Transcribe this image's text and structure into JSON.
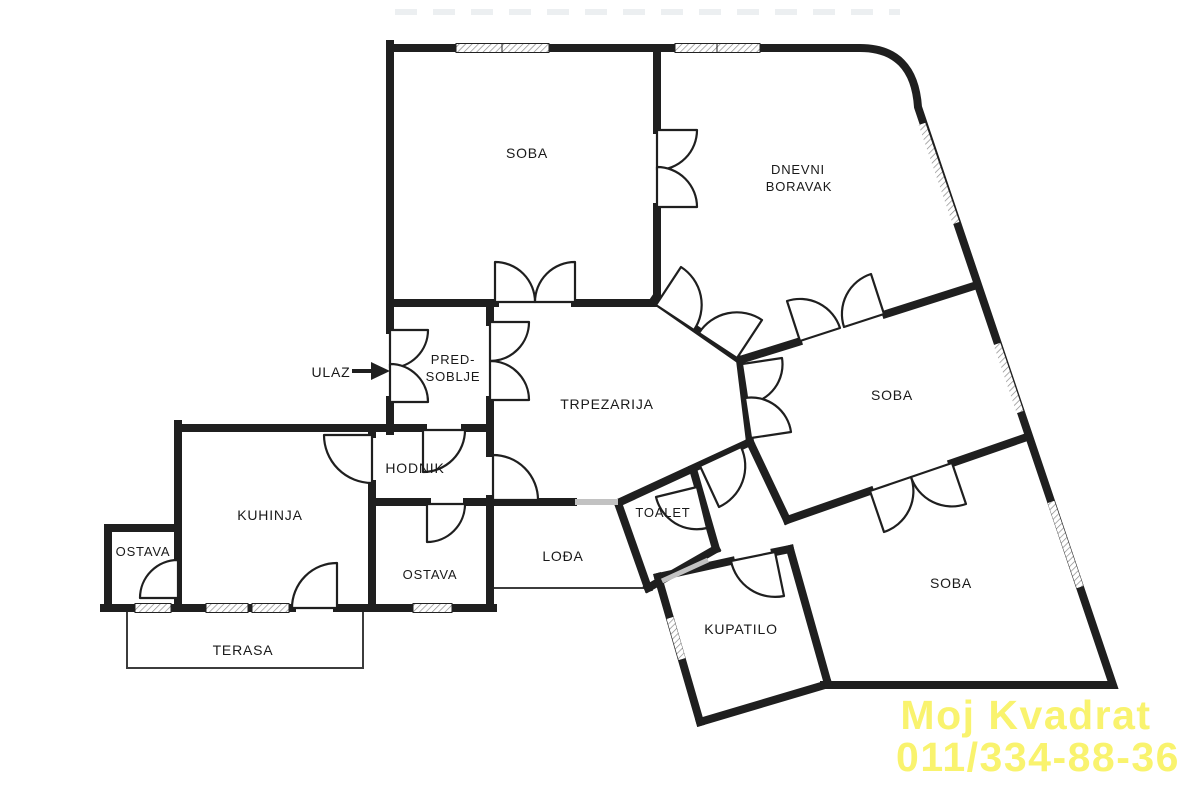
{
  "plan": {
    "title": "apartment-floor-plan",
    "background": "#ffffff",
    "wall_color": "#1f1f1f"
  },
  "rooms": {
    "soba_top": "SOBA",
    "dnevni_line1": "DNEVNI",
    "dnevni_line2": "BORAVAK",
    "pred_line1": "PRED-",
    "pred_line2": "SOBLJE",
    "trpezarija": "TRPEZARIJA",
    "soba_mid": "SOBA",
    "hodnik": "HODNIK",
    "kuhinja": "KUHINJA",
    "ostava_left": "OSTAVA",
    "ostava_mid": "OSTAVA",
    "lodja": "LOĐA",
    "toalet": "TOALET",
    "kupatilo": "KUPATILO",
    "soba_bottom": "SOBA",
    "terasa": "TERASA"
  },
  "entrance": {
    "label": "ULAZ"
  },
  "watermark": {
    "line1": "Moj Kvadrat",
    "line2": "011/334-88-36",
    "color": "#f8f155"
  }
}
